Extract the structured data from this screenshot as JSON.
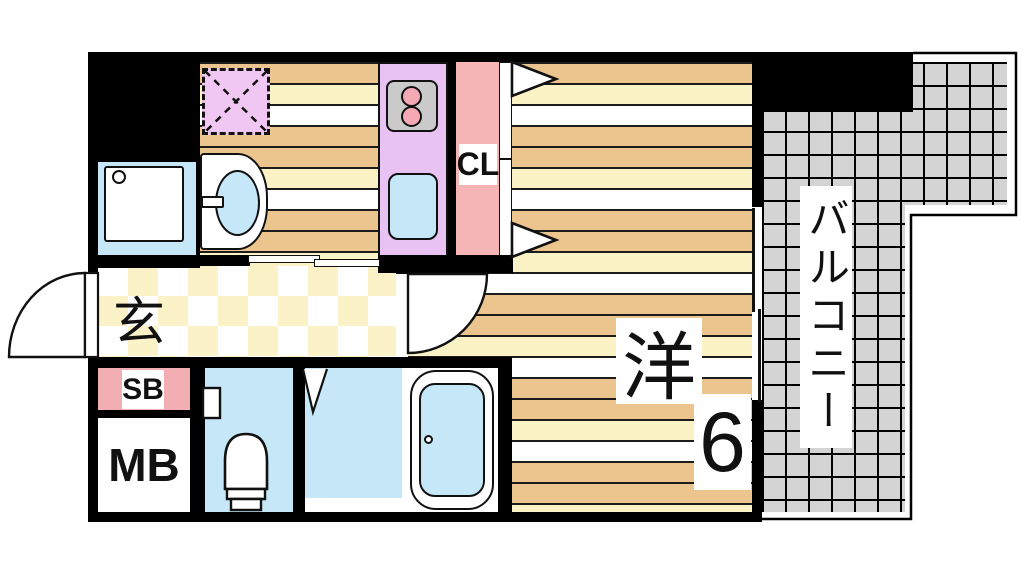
{
  "labels": {
    "entrance": "玄",
    "shoe_box": "SB",
    "meter_box": "MB",
    "closet": "CL",
    "western_room": "洋",
    "western_room_size": "6",
    "balcony": "バルコニー"
  },
  "colors": {
    "wall": "#000000",
    "stripe_line": "#1C1C1C",
    "floor_tan": "#ECC48D",
    "floor_cream": "#FBF2C5",
    "checker_cream": "#FBF2C8",
    "kitchen_purple": "#E8C2F2",
    "fridge_purple": "#F0C6F2",
    "closet_pink": "#F5B5B5",
    "shoebox_pink": "#F2AEB2",
    "water_blue": "#C5E7F8",
    "balcony_gray": "#D4D4D4",
    "stove_gray": "#CACACA",
    "burner_pink": "#F4A9B4"
  }
}
